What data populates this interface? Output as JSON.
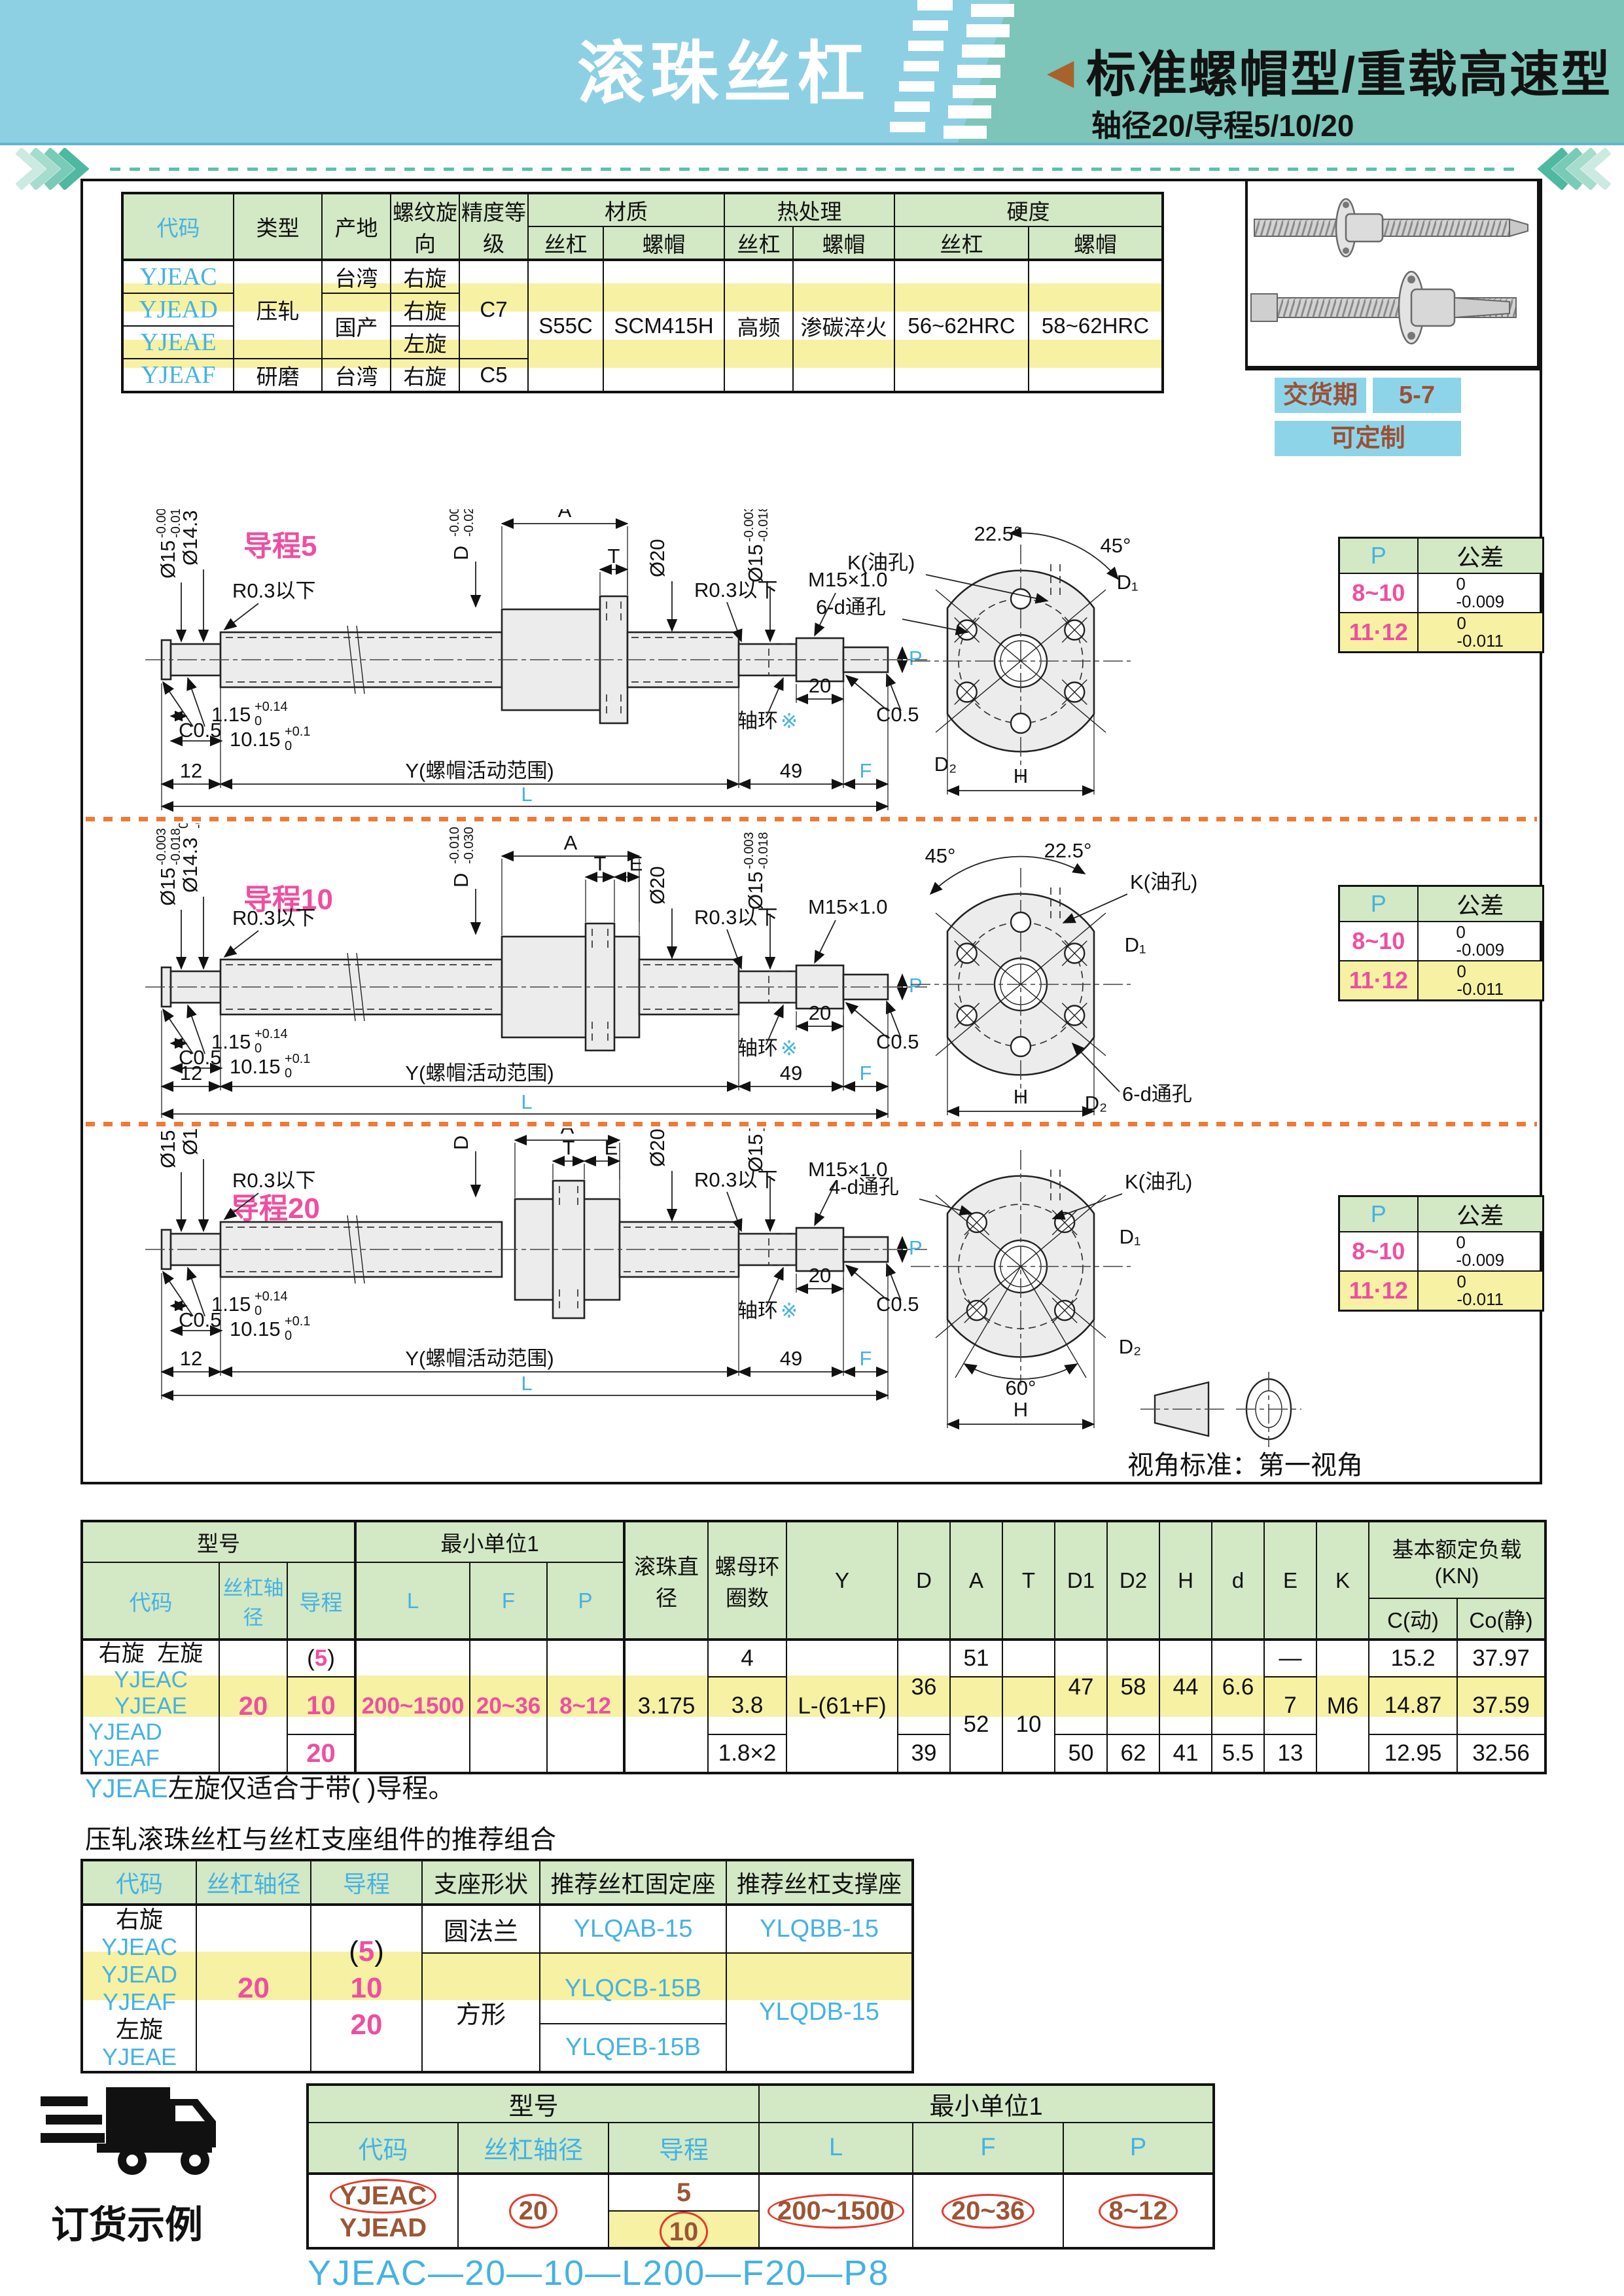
{
  "page_header": {
    "title": "滚珠丝杠",
    "arrow": "◀",
    "section_title": "标准螺帽型/重载高速型",
    "section_subtitle": "轴径20/导程5/10/20"
  },
  "info_box": {
    "delivery_label": "交货期",
    "delivery_value": "5-7",
    "custom_label": "可定制"
  },
  "top_table": {
    "h_code": "代码",
    "h_type": "类型",
    "h_origin": "产地",
    "h_thread": "螺纹旋向",
    "h_precision": "精度等级",
    "h_material": "材质",
    "h_heat": "热处理",
    "h_hardness": "硬度",
    "h_screw": "丝杠",
    "h_nut": "螺帽",
    "codes": [
      "YJEAC",
      "YJEAD",
      "YJEAE",
      "YJEAF"
    ],
    "type_rolled": "压轧",
    "type_ground": "研磨",
    "origin_1": "台湾",
    "origin_23": "国产",
    "origin_4": "台湾",
    "dir_1": "右旋",
    "dir_2": "右旋",
    "dir_3": "左旋",
    "dir_4": "右旋",
    "precision_123": "C7",
    "precision_4": "C5",
    "mat_screw": "S55C",
    "mat_nut": "SCM415H",
    "heat_screw": "高频",
    "heat_nut": "渗碳淬火",
    "hard_screw": "56~62HRC",
    "hard_nut": "58~62HRC"
  },
  "tolerance_table": {
    "h_p": "P",
    "h_tol": "公差",
    "r1_p": "8~10",
    "r1_hi": "0",
    "r1_lo": "-0.009",
    "r2_p": "11·12",
    "r2_hi": "0",
    "r2_lo": "-0.011"
  },
  "drawings": {
    "lead5_label": "导程5",
    "lead10_label": "导程10",
    "lead20_label": "导程20",
    "dia15": "Ø15",
    "dia15_hi": "-0.003",
    "dia15_lo": "-0.018",
    "dia143": "Ø14.3",
    "dia143_hi": "0",
    "dia143_lo": "-0.11",
    "r03": "R0.3以下",
    "dia20": "Ø20",
    "m15": "M15×1.0",
    "c05": "C0.5",
    "d_label": "D",
    "d5_hi": "-0.009",
    "d5_lo": "-0.025",
    "d10_hi": "-0.010",
    "d10_lo": "-0.030",
    "d20_hi": "-0.010",
    "d20_lo": "-0.038",
    "dim_a": "A",
    "dim_t": "T",
    "dim_e": "E",
    "collar": "轴环",
    "collar_mark": "※",
    "len115": "1.15",
    "len115_hi": "+0.14",
    "len115_lo": "0",
    "len1015": "10.15",
    "len1015_hi": "+0.1",
    "len1015_lo": "0",
    "len12": "12",
    "y_range": "Y(螺帽活动范围)",
    "len49": "49",
    "len20": "20",
    "dim_f": "F",
    "dim_l": "L",
    "dim_p": "P",
    "k_oil": "K(油孔)",
    "deg225": "22.5°",
    "deg45": "45°",
    "deg60": "60°",
    "holes6": "6-d通孔",
    "holes4": "4-d通孔",
    "d1": "D₁",
    "d2": "D₂",
    "dim_h": "H",
    "view_note": "视角标准：第一视角"
  },
  "main_table": {
    "h_model": "型号",
    "h_min_unit": "最小单位1",
    "h_ball": "滚珠直径",
    "h_rings": "螺母环圈数",
    "h_y": "Y",
    "h_d": "D",
    "h_a": "A",
    "h_t": "T",
    "h_d1": "D1",
    "h_d2": "D2",
    "h_h": "H",
    "h_ds": "d",
    "h_e": "E",
    "h_k": "K",
    "h_load": "基本额定负载",
    "h_load_unit": "(KN)",
    "h_c": "C(动)",
    "h_co": "Co(静)",
    "h_code": "代码",
    "h_shaft": "丝杠轴径",
    "h_lead": "导程",
    "h_l": "L",
    "h_f": "F",
    "h_p": "P",
    "code_right": "右旋",
    "code_left": "左旋",
    "codes_1": "YJEAC YJEAE",
    "codes_2": "YJEAD",
    "codes_3": "YJEAF",
    "shaft_dia": "20",
    "lead_1_open": "(",
    "lead_1_num": "5",
    "lead_1_close": ")",
    "lead_2": "10",
    "lead_3": "20",
    "l_range": "200~1500",
    "f_range": "20~36",
    "p_range": "8~12",
    "ball_dia": "3.175",
    "rings_1": "4",
    "rings_2": "3.8",
    "rings_3": "1.8×2",
    "y_formula": "L-(61+F)",
    "d_12": "36",
    "d_3": "39",
    "a_1": "51",
    "a_23": "52",
    "t_23": "10",
    "d1_12": "47",
    "d1_3": "50",
    "d2_12": "58",
    "d2_3": "62",
    "h_12": "44",
    "h_3": "41",
    "ds_12": "6.6",
    "ds_3": "5.5",
    "e_1": "—",
    "e_2": "7",
    "e_3": "13",
    "k": "M6",
    "c_1": "15.2",
    "c_2": "14.87",
    "c_3": "12.95",
    "co_1": "37.97",
    "co_2": "37.59",
    "co_3": "32.56"
  },
  "note": {
    "code": "YJEAE",
    "text": "左旋仅适合于带( )导程。"
  },
  "recommend": {
    "heading": "压轧滚珠丝杠与丝杠支座组件的推荐组合",
    "h_code": "代码",
    "h_shaft": "丝杠轴径",
    "h_lead": "导程",
    "h_shape": "支座形状",
    "h_fixed": "推荐丝杠固定座",
    "h_support": "推荐丝杠支撑座",
    "code_right": "右旋",
    "code_1": "YJEAC",
    "code_2": "YJEAD",
    "code_3": "YJEAF",
    "code_left": "左旋",
    "code_4": "YJEAE",
    "shaft_dia": "20",
    "lead_1_open": "(",
    "lead_1_num": "5",
    "lead_1_close": ")",
    "lead_2": "10",
    "lead_3": "20",
    "shape_1": "圆法兰",
    "shape_23": "方形",
    "fixed_1": "YLQAB-15",
    "fixed_2": "YLQCB-15B",
    "fixed_3": "YLQEB-15B",
    "support_1": "YLQBB-15",
    "support_23": "YLQDB-15"
  },
  "order_example": {
    "label": "订货示例",
    "h_model": "型号",
    "h_min_unit": "最小单位1",
    "h_code": "代码",
    "h_shaft": "丝杠轴径",
    "h_lead": "导程",
    "h_l": "L",
    "h_f": "F",
    "h_p": "P",
    "code_1": "YJEAC",
    "code_2": "YJEAD",
    "shaft_dia": "20",
    "lead_1": "5",
    "lead_2": "10",
    "l_range": "200~1500",
    "f_range": "20~36",
    "p_range": "8~12",
    "result": "YJEAC—20—10—L200—F20—P8"
  }
}
